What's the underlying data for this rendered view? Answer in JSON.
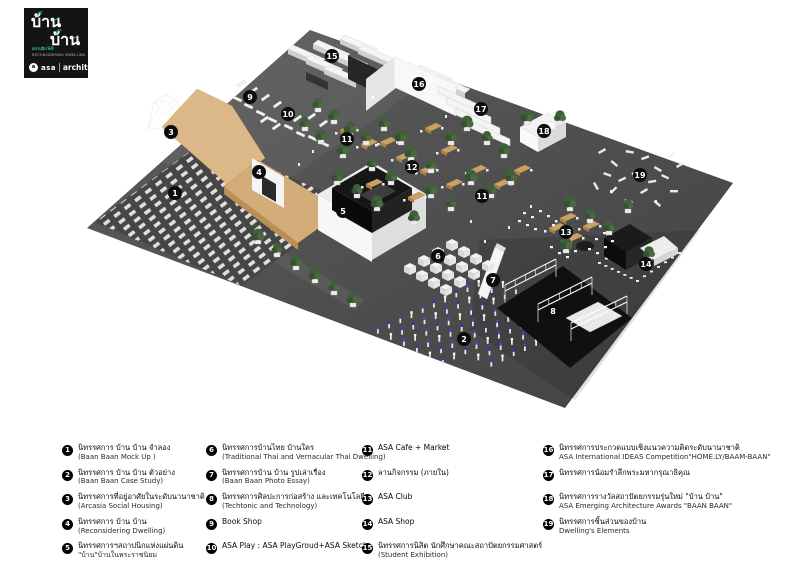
{
  "logo": {
    "thai_line1": "บ้าน",
    "thai_line2": "บ้าน",
    "small_line1": "สถาปนิก'60",
    "small_line2": "RECONSIDERING DWELLING",
    "asa_label": "asa",
    "event_label": "architect'17"
  },
  "colors": {
    "accent_teal": "#3bc4b4",
    "floor_gray": "#515151",
    "wood_tan": "#d6b181",
    "structure_black": "#141414",
    "tree_green": "#3f5a33",
    "model_blue": "#3a3aa8",
    "panel_white": "#f4f4f4"
  },
  "map": {
    "markers": [
      {
        "n": "1",
        "x": 175,
        "y": 193
      },
      {
        "n": "2",
        "x": 464,
        "y": 339
      },
      {
        "n": "3",
        "x": 171,
        "y": 132
      },
      {
        "n": "4",
        "x": 259,
        "y": 172
      },
      {
        "n": "5",
        "x": 343,
        "y": 211
      },
      {
        "n": "6",
        "x": 438,
        "y": 256
      },
      {
        "n": "7",
        "x": 493,
        "y": 280
      },
      {
        "n": "8",
        "x": 553,
        "y": 311
      },
      {
        "n": "9",
        "x": 250,
        "y": 97
      },
      {
        "n": "10",
        "x": 288,
        "y": 114
      },
      {
        "n": "11",
        "x": 347,
        "y": 139
      },
      {
        "n": "11",
        "x": 482,
        "y": 196
      },
      {
        "n": "12",
        "x": 412,
        "y": 167
      },
      {
        "n": "13",
        "x": 566,
        "y": 232
      },
      {
        "n": "14",
        "x": 646,
        "y": 264
      },
      {
        "n": "15",
        "x": 332,
        "y": 56
      },
      {
        "n": "16",
        "x": 419,
        "y": 84
      },
      {
        "n": "17",
        "x": 481,
        "y": 109
      },
      {
        "n": "18",
        "x": 544,
        "y": 131
      },
      {
        "n": "19",
        "x": 640,
        "y": 175
      }
    ]
  },
  "legend": {
    "columns": [
      {
        "items": [
          {
            "n": "1",
            "lines": [
              "นิทรรศการ บ้าน บ้าน จำลอง",
              "(Baan Baan Mock Up )"
            ]
          },
          {
            "n": "2",
            "lines": [
              "นิทรรศการ บ้าน บ้าน ตัวอย่าง",
              "(Baan Baan Case Study)"
            ]
          },
          {
            "n": "3",
            "lines": [
              "นิทรรศการที่อยู่อาศัยในระดับนานาชาติ",
              "(Arcasia Social Housing)"
            ]
          },
          {
            "n": "4",
            "lines": [
              "นิทรรศการ บ้าน บ้าน",
              "(Reconsidering Dwelling)"
            ]
          },
          {
            "n": "5",
            "lines": [
              "นิทรรศการฯสถาปนิกแห่งแผ่นดิน",
              "\"บ้าน\"บ้านในพระราชนิยม"
            ]
          }
        ]
      },
      {
        "items": [
          {
            "n": "6",
            "lines": [
              "นิทรรศการบ้านไทย บ้านใคร",
              "(Traditional Thai and Vernacular Thai Dwelling)"
            ]
          },
          {
            "n": "7",
            "lines": [
              "นิทรรศการบ้าน บ้าน รูปเล่าเรื่อง",
              "(Baan Baan Photo Essay)"
            ]
          },
          {
            "n": "8",
            "lines": [
              "นิทรรศการศิลปะการก่อสร้าง และเทคโนโลยี",
              "(Techtonic and Technology)"
            ]
          },
          {
            "n": "9",
            "lines": [
              "Book Shop"
            ]
          },
          {
            "n": "10",
            "lines": [
              "ASA Play : ASA PlayGroud+ASA Sketch"
            ]
          }
        ]
      },
      {
        "items": [
          {
            "n": "11",
            "lines": [
              "ASA Cafe + Market"
            ]
          },
          {
            "n": "12",
            "lines": [
              "ลานกิจกรรม (ภายใน)"
            ]
          },
          {
            "n": "13",
            "lines": [
              "ASA Club"
            ]
          },
          {
            "n": "14",
            "lines": [
              "ASA Shop"
            ]
          },
          {
            "n": "15",
            "lines": [
              "นิทรรศการนิสิต นักศึกษาคณะสถาปัตยกรรมศาสตร์",
              "(Student Exhibition)"
            ]
          }
        ]
      },
      {
        "items": [
          {
            "n": "16",
            "lines": [
              "นิทรรศการประกวดแบบเชิงแนวความคิดระดับนานาชาติ",
              "ASA International IDEAS Competition\"HOME.LY/BAAM-BAAN\""
            ]
          },
          {
            "n": "17",
            "lines": [
              "นิทรรศการน้อมรำลึกพระมหากรุณาธิคุณ"
            ]
          },
          {
            "n": "18",
            "lines": [
              "นิทรรศการรางวัลสถาปัตยกรรมรุ่นใหม่ \"บ้าน บ้าน\"",
              "ASA Emerging Architecture Awards \"BAAN BAAN\""
            ]
          },
          {
            "n": "19",
            "lines": [
              "นิทรรศการชิ้นส่วนของบ้าน",
              "Dwelling's Elements"
            ]
          }
        ]
      }
    ]
  }
}
